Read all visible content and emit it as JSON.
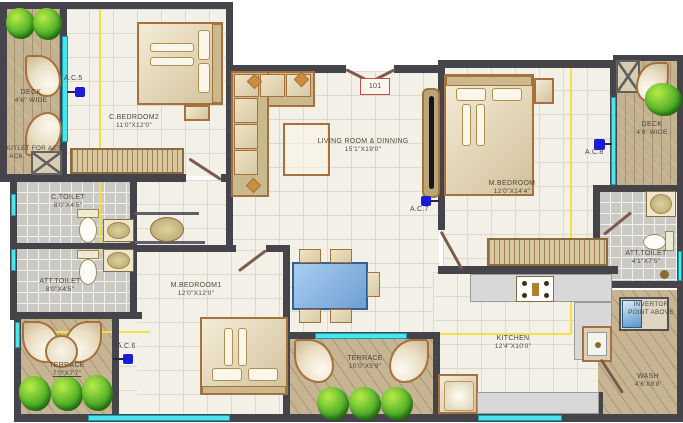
{
  "rooms": {
    "deck_left": {
      "name": "DECK",
      "dims": "4'6\" WIDE"
    },
    "c_bedroom2": {
      "name": "C.BEDROOM2",
      "dims": "11'0\"X12'0\""
    },
    "c_toilet": {
      "name": "C.TOILET",
      "dims": "8'0\"X4'5\""
    },
    "att_toilet_left": {
      "name": "ATT.TOILET",
      "dims": "8'0\"X4'5\""
    },
    "terrace_left": {
      "name": "TERRACE",
      "dims": "7'0\"X7'7\""
    },
    "m_bedroom1": {
      "name": "M.BEDROOM1",
      "dims": "12'0\"X12'0\""
    },
    "living": {
      "name": "LIVING ROOM & DINNING",
      "dims": "15'1\"X19'0\""
    },
    "terrace_bottom": {
      "name": "TERRACE",
      "dims": "10'0\"X5'9\""
    },
    "m_bedroom": {
      "name": "M.BEDROOM",
      "dims": "12'0\"X14'4\""
    },
    "kitchen": {
      "name": "KITCHEN",
      "dims": "12'4\"X10'0\""
    },
    "deck_right": {
      "name": "DECK",
      "dims": "4'6' WIDE"
    },
    "att_toilet_right": {
      "name": "ATT.TOILET",
      "dims": "4'1\"X7'5\""
    },
    "wash": {
      "name": "WASH",
      "dims": "4'6'X8'8'"
    },
    "invertor": {
      "note": "INVERTOR POINT ABOVE"
    },
    "outlet": {
      "note": "OUTLET FOR AC5 & AC6"
    }
  },
  "ac_points": {
    "ac5": "A.C.5",
    "ac6": "A.C.6",
    "ac7": "A.C.7",
    "ac8": "A.C.8"
  },
  "entry": {
    "unit_tag": "101"
  },
  "colors": {
    "wall": "#45444a",
    "window_glass": "#49e6ec",
    "ac_marker": "#1b1bd8",
    "wood_deck": "#c3b190",
    "toilet_tile": "#cbc9c4",
    "room_floor": "#f3f0e7",
    "furniture_outline": "#a6713c",
    "dining_table": "#82b4e2",
    "unit_tag_border": "#c0504d",
    "service_line": "#f1e242"
  }
}
